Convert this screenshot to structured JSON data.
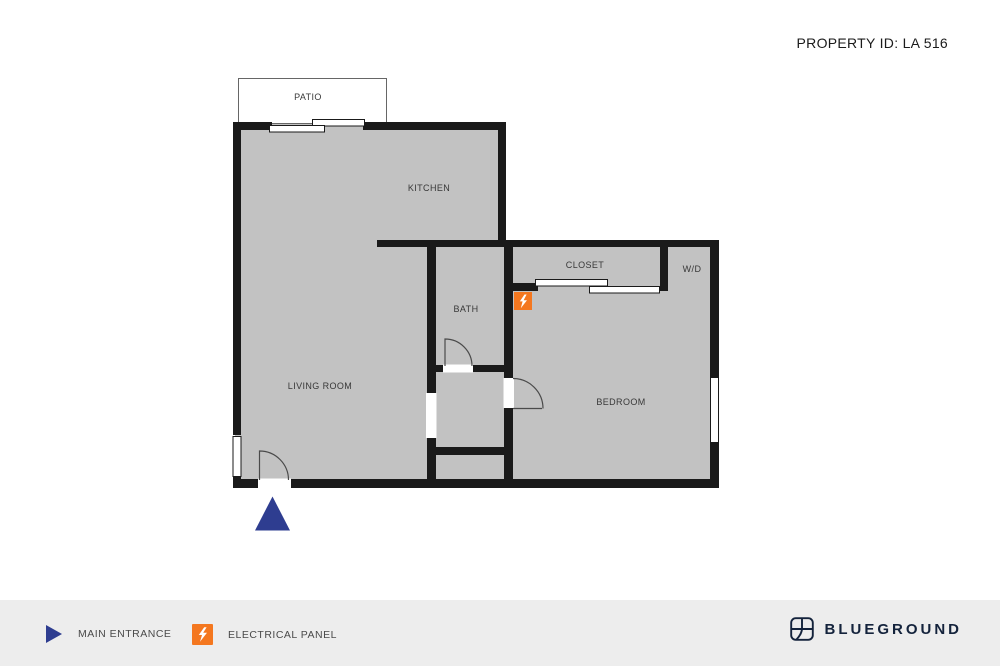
{
  "header": {
    "property_id": "PROPERTY ID: LA 516"
  },
  "floor_plan": {
    "rooms": {
      "patio": "PATIO",
      "kitchen": "KITCHEN",
      "living_room": "LIVING ROOM",
      "bath": "BATH",
      "closet": "CLOSET",
      "washer_dryer": "W/D",
      "bedroom": "BEDROOM"
    },
    "markers": {
      "main_entrance": "navy triangle below entrance door",
      "electrical_panel": "orange square with lightning bolt near closet"
    }
  },
  "legend": {
    "items": [
      {
        "icon": "entrance-triangle-icon",
        "label": "MAIN ENTRANCE"
      },
      {
        "icon": "electrical-panel-icon",
        "label": "ELECTRICAL PANEL"
      }
    ]
  },
  "brand": {
    "name": "BLUEGROUND"
  },
  "colors": {
    "wall": "#1A1A1A",
    "floor_fill": "#C2C2C2",
    "accent_orange": "#F4771F",
    "entrance_navy": "#2E3D90",
    "brand_navy": "#14233C",
    "footer_bg": "#EDEDED",
    "page_bg": "#FFFFFF"
  }
}
